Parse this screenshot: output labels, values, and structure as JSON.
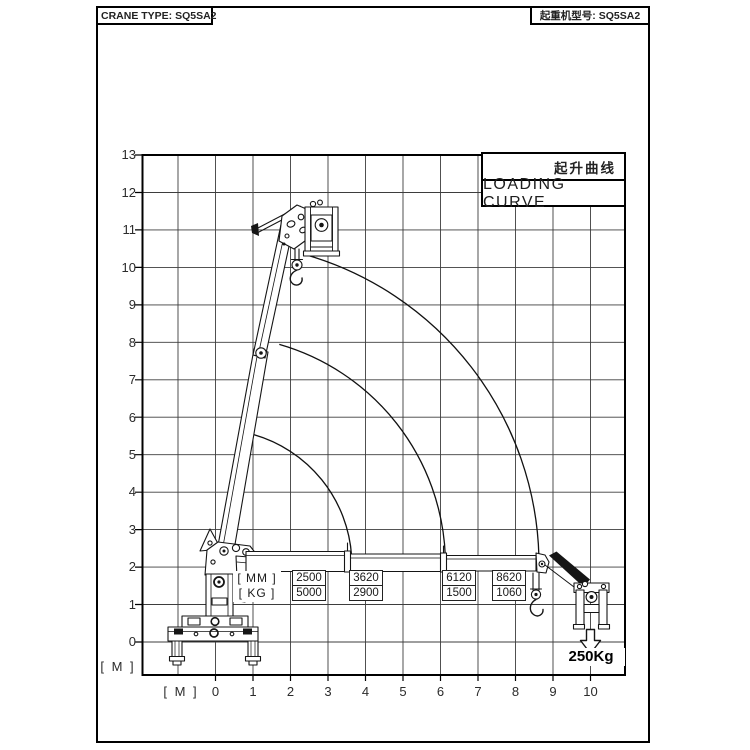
{
  "header": {
    "title_left": "CRANE TYPE: SQ5SA2",
    "title_right": "起重机型号: SQ5SA2"
  },
  "legend": {
    "title_cn": "起升曲线",
    "title_en": "LOADING CURVE"
  },
  "axes": {
    "y_unit": "[ M ]",
    "x_unit": "[ M ]",
    "y_ticks": [
      "13",
      "12",
      "11",
      "10",
      "9",
      "8",
      "7",
      "6",
      "5",
      "4",
      "3",
      "2",
      "1",
      "0"
    ],
    "x_ticks": [
      "0",
      "1",
      "2",
      "3",
      "4",
      "5",
      "6",
      "7",
      "8",
      "9",
      "10"
    ]
  },
  "load_table": {
    "mm_label": "[ MM ]",
    "kg_label": "[ KG ]",
    "columns": [
      {
        "mm": "2500",
        "kg": "5000"
      },
      {
        "mm": "3620",
        "kg": "2900"
      },
      {
        "mm": "6120",
        "kg": "1500"
      },
      {
        "mm": "8620",
        "kg": "1060"
      }
    ]
  },
  "annotation": {
    "max_load": "250Kg"
  },
  "colors": {
    "line": "#151515",
    "grid": "#3d3d3d",
    "background": "#ffffff"
  },
  "chart_data": {
    "type": "line",
    "title": "LOADING CURVE / 起升曲线",
    "xlabel": "[ M ]",
    "ylabel": "[ M ]",
    "xlim": [
      -2,
      10.9
    ],
    "ylim": [
      -0.9,
      13
    ],
    "grid": true,
    "x_ticks": [
      0,
      1,
      2,
      3,
      4,
      5,
      6,
      7,
      8,
      9,
      10
    ],
    "y_ticks": [
      0,
      1,
      2,
      3,
      4,
      5,
      6,
      7,
      8,
      9,
      10,
      11,
      12,
      13
    ],
    "boom_pivot": {
      "x_m": 0,
      "y_m": 2.1
    },
    "arcs": [
      {
        "name": "boom extension 3620 mm",
        "center": {
          "x_m": 0,
          "y_m": 2.1
        },
        "radius_m": 3.62,
        "angle_deg": [
          2,
          74
        ]
      },
      {
        "name": "boom extension 6120 mm",
        "center": {
          "x_m": 0,
          "y_m": 2.1
        },
        "radius_m": 6.12,
        "angle_deg": [
          2,
          74
        ]
      },
      {
        "name": "boom extension 8620 mm",
        "center": {
          "x_m": 0,
          "y_m": 2.1
        },
        "radius_m": 8.62,
        "angle_deg": [
          2,
          74
        ]
      }
    ],
    "capacity_table": {
      "reach_mm": [
        2500,
        3620,
        6120,
        8620
      ],
      "capacity_kg": [
        5000,
        2900,
        1500,
        1060
      ]
    },
    "annotations": [
      "250Kg"
    ]
  }
}
